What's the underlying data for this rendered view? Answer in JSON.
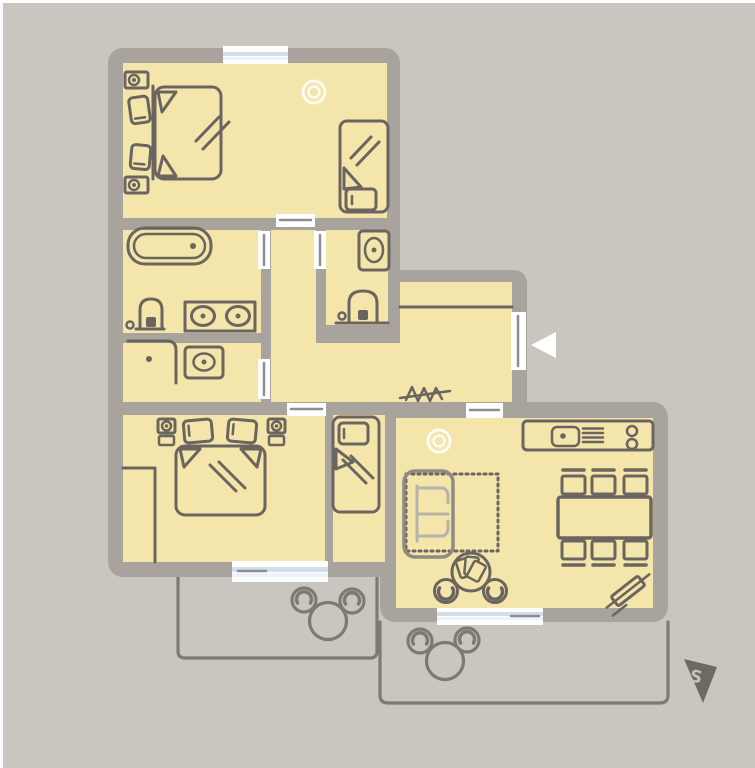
{
  "meta": {
    "type": "apartment-floor-plan",
    "orientation_marker": "south-pennant"
  },
  "compass": {
    "label": "S"
  },
  "colors": {
    "background": "#c9c5bf",
    "page_white": "#fdfdfd",
    "wall": "#a8a39c",
    "room": "#f4e5ab",
    "line": "#6b6560",
    "door_leaf": "#908c90",
    "window_glass": "#ffffff",
    "window_blue": "#d3deed",
    "window_blue_light": "#eef3f9",
    "terrace": "#7d7973",
    "sofa_light": "#b7b2aa",
    "sofa_frame": "#8f8b84",
    "lamp_white": "#fcfaf5",
    "compass_bg": "#6e6963",
    "compass_text": "#c6c2bc",
    "arrow_white": "#ffffff"
  },
  "rooms": [
    {
      "id": "bedroom-1",
      "furniture": [
        "double-bed",
        "pillow",
        "pillow",
        "nightstand-lamp",
        "nightstand-lamp",
        "single-bed",
        "ceiling-lamp"
      ]
    },
    {
      "id": "bathroom",
      "furniture": [
        "bathtub",
        "toilet",
        "double-sink-vanity"
      ]
    },
    {
      "id": "shower-room",
      "furniture": [
        "corner-shower",
        "washbasin"
      ]
    },
    {
      "id": "wc",
      "furniture": [
        "washbasin",
        "toilet"
      ]
    },
    {
      "id": "hallway",
      "furniture": [
        "wardrobe-line",
        "coat-rack",
        "entrance-door",
        "entrance-arrow"
      ]
    },
    {
      "id": "bedroom-2",
      "furniture": [
        "double-bed",
        "pillow",
        "pillow",
        "nightstand-lamp",
        "nightstand-lamp",
        "closet"
      ]
    },
    {
      "id": "bedroom-3",
      "furniture": [
        "single-bed"
      ]
    },
    {
      "id": "living-kitchen",
      "furniture": [
        "kitchen-counter",
        "stove",
        "grill-vent",
        "knobs",
        "dining-table",
        "stool",
        "stool",
        "stool",
        "stool",
        "stool",
        "stool",
        "sofa-bed",
        "fold-out-outline",
        "card-table",
        "chair",
        "chair",
        "ceiling-lamp",
        "ironing-board"
      ]
    },
    {
      "id": "terrace-1",
      "furniture": [
        "round-table",
        "chair",
        "chair"
      ]
    },
    {
      "id": "terrace-2",
      "furniture": [
        "round-table",
        "chair",
        "chair"
      ]
    }
  ],
  "openings": {
    "windows": 3,
    "interior_doors": 6,
    "entrance_doors": 1
  }
}
